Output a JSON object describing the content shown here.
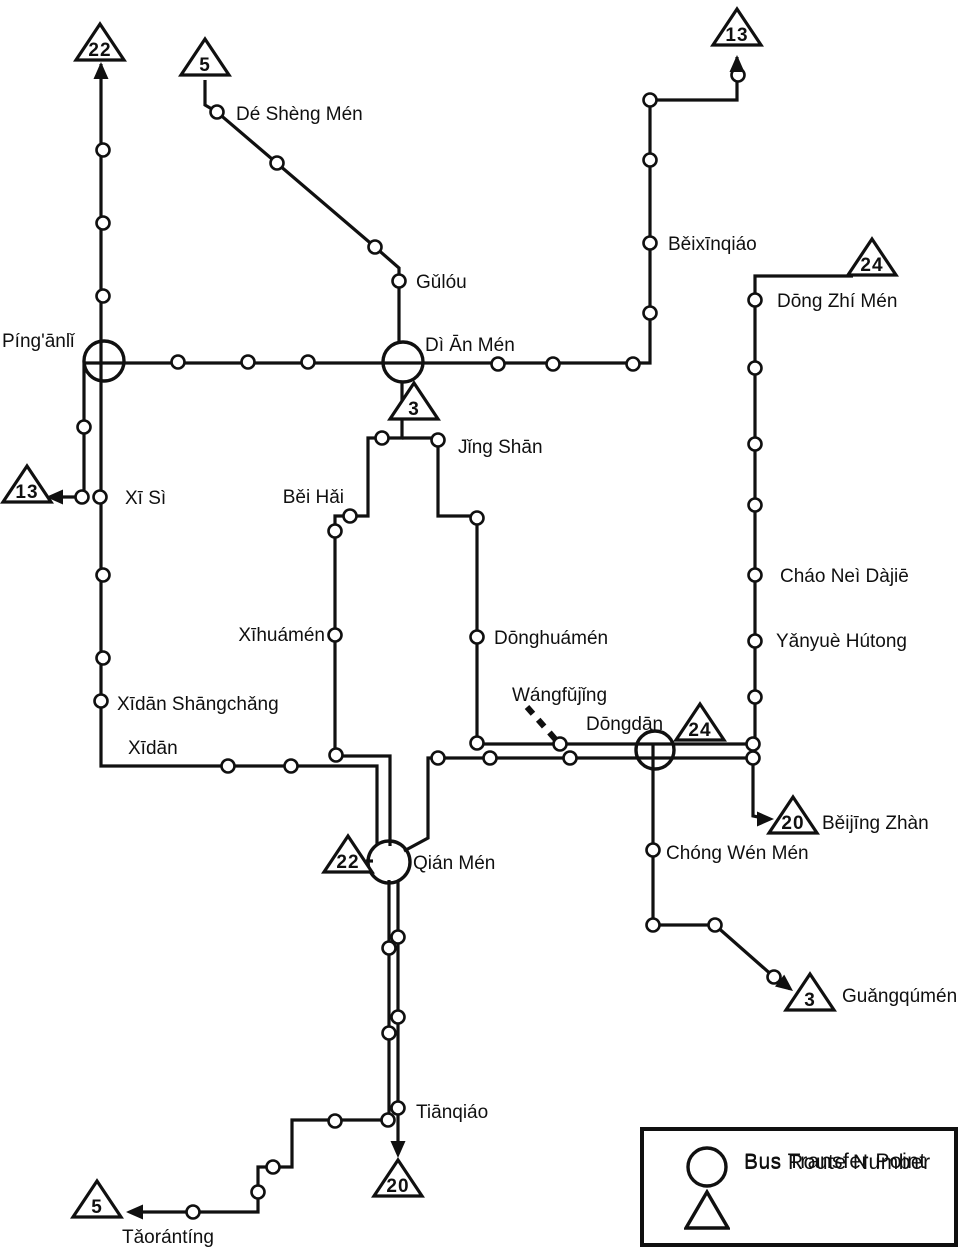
{
  "colors": {
    "ink": "#101010",
    "bg": "#ffffff"
  },
  "legend": {
    "transfer_label": "Bus Transfer Point",
    "route_label": "Bus Route Number"
  },
  "map": {
    "width": 971,
    "height": 1254,
    "lines": [
      {
        "name": "route-22-vertical-and-xidan-east",
        "points": [
          [
            101,
            64
          ],
          [
            101,
            766
          ],
          [
            377,
            766
          ],
          [
            377,
            845
          ]
        ]
      },
      {
        "name": "route-5-north-diagonal",
        "points": [
          [
            205,
            80
          ],
          [
            205,
            105
          ],
          [
            217,
            112
          ],
          [
            375,
            247
          ],
          [
            399,
            268
          ],
          [
            399,
            344
          ]
        ]
      },
      {
        "name": "route-5-west-palace-loop",
        "points": [
          [
            402,
            381
          ],
          [
            402,
            438
          ],
          [
            368,
            438
          ],
          [
            368,
            516
          ],
          [
            335,
            516
          ],
          [
            335,
            756
          ],
          [
            390,
            756
          ],
          [
            390,
            846
          ]
        ]
      },
      {
        "name": "route-3-east-palace-loop",
        "points": [
          [
            402,
            438
          ],
          [
            438,
            438
          ],
          [
            438,
            516
          ],
          [
            477,
            516
          ],
          [
            477,
            744
          ],
          [
            755,
            744
          ]
        ]
      },
      {
        "name": "route-3-south-branch",
        "points": [
          [
            653,
            744
          ],
          [
            653,
            925
          ],
          [
            715,
            925
          ],
          [
            774,
            977
          ],
          [
            790,
            989
          ]
        ]
      },
      {
        "name": "route-24-vertical",
        "points": [
          [
            853,
            276
          ],
          [
            755,
            276
          ],
          [
            755,
            744
          ]
        ]
      },
      {
        "name": "route-13-long-line",
        "points": [
          [
            737,
            57
          ],
          [
            737,
            100
          ],
          [
            650,
            100
          ],
          [
            650,
            363
          ],
          [
            84,
            363
          ],
          [
            84,
            497
          ],
          [
            52,
            497
          ]
        ]
      },
      {
        "name": "route-20-beijing-zhan-spur",
        "points": [
          [
            753,
            758
          ],
          [
            753,
            816
          ],
          [
            768,
            819
          ]
        ]
      },
      {
        "name": "route-20-main",
        "points": [
          [
            753,
            758
          ],
          [
            428,
            758
          ],
          [
            428,
            838
          ],
          [
            404,
            851
          ]
        ]
      },
      {
        "name": "route-20-south",
        "points": [
          [
            398,
            880
          ],
          [
            398,
            1150
          ]
        ]
      },
      {
        "name": "route-5-south-stairs",
        "points": [
          [
            389,
            880
          ],
          [
            389,
            1120
          ],
          [
            292,
            1120
          ],
          [
            292,
            1167
          ],
          [
            258,
            1167
          ],
          [
            258,
            1212
          ],
          [
            138,
            1212
          ]
        ]
      },
      {
        "name": "qianmen-badge-connector",
        "points": [
          [
            366,
            861
          ],
          [
            373,
            861
          ]
        ]
      }
    ],
    "dashed_lines": [
      {
        "name": "wangfujing-pointer",
        "points": [
          [
            527,
            707
          ],
          [
            556,
            740
          ]
        ]
      }
    ],
    "stops": [
      [
        103,
        150
      ],
      [
        103,
        223
      ],
      [
        103,
        296
      ],
      [
        178,
        362
      ],
      [
        248,
        362
      ],
      [
        308,
        362
      ],
      [
        498,
        364
      ],
      [
        553,
        364
      ],
      [
        633,
        364
      ],
      [
        84,
        427
      ],
      [
        82,
        497
      ],
      [
        100,
        497
      ],
      [
        103,
        575
      ],
      [
        103,
        658
      ],
      [
        101,
        701
      ],
      [
        228,
        766
      ],
      [
        291,
        766
      ],
      [
        217,
        112
      ],
      [
        277,
        163
      ],
      [
        375,
        247
      ],
      [
        399,
        281
      ],
      [
        738,
        75
      ],
      [
        650,
        100
      ],
      [
        650,
        160
      ],
      [
        650,
        243
      ],
      [
        650,
        313
      ],
      [
        755,
        300
      ],
      [
        755,
        368
      ],
      [
        755,
        444
      ],
      [
        755,
        505
      ],
      [
        755,
        575
      ],
      [
        755,
        641
      ],
      [
        755,
        697
      ],
      [
        382,
        438
      ],
      [
        350,
        516
      ],
      [
        335,
        531
      ],
      [
        335,
        635
      ],
      [
        336,
        755
      ],
      [
        438,
        440
      ],
      [
        477,
        518
      ],
      [
        477,
        637
      ],
      [
        477,
        743
      ],
      [
        560,
        744
      ],
      [
        438,
        758
      ],
      [
        490,
        758
      ],
      [
        570,
        758
      ],
      [
        753,
        744
      ],
      [
        753,
        758
      ],
      [
        389,
        948
      ],
      [
        398,
        937
      ],
      [
        389,
        1033
      ],
      [
        398,
        1017
      ],
      [
        398,
        1108
      ],
      [
        388,
        1120
      ],
      [
        335,
        1121
      ],
      [
        273,
        1167
      ],
      [
        258,
        1192
      ],
      [
        193,
        1212
      ],
      [
        653,
        850
      ],
      [
        653,
        925
      ],
      [
        715,
        925
      ],
      [
        774,
        977
      ]
    ],
    "transfer_points": [
      {
        "name": "Píng'ānlǐ",
        "x": 104,
        "y": 361,
        "r": 20
      },
      {
        "name": "Dì Ān Mén",
        "x": 403,
        "y": 362,
        "r": 20
      },
      {
        "name": "Dōngdān",
        "x": 655,
        "y": 750,
        "r": 19
      },
      {
        "name": "Qián Mén",
        "x": 389,
        "y": 862,
        "r": 21
      }
    ],
    "route_badges": [
      {
        "number": "22",
        "x": 100,
        "y": 45
      },
      {
        "number": "5",
        "x": 205,
        "y": 60
      },
      {
        "number": "13",
        "x": 737,
        "y": 30
      },
      {
        "number": "24",
        "x": 872,
        "y": 260
      },
      {
        "number": "13",
        "x": 27,
        "y": 487
      },
      {
        "number": "3",
        "x": 414,
        "y": 404
      },
      {
        "number": "24",
        "x": 700,
        "y": 725
      },
      {
        "number": "20",
        "x": 793,
        "y": 818
      },
      {
        "number": "22",
        "x": 348,
        "y": 857
      },
      {
        "number": "3",
        "x": 810,
        "y": 995
      },
      {
        "number": "20",
        "x": 398,
        "y": 1181
      },
      {
        "number": "5",
        "x": 97,
        "y": 1202
      }
    ],
    "arrows": [
      {
        "x": 101,
        "y": 62,
        "angle": -90
      },
      {
        "x": 737,
        "y": 55,
        "angle": -90
      },
      {
        "x": 46,
        "y": 497,
        "angle": 180
      },
      {
        "x": 774,
        "y": 819,
        "angle": 0
      },
      {
        "x": 793,
        "y": 991,
        "angle": 38
      },
      {
        "x": 398,
        "y": 1158,
        "angle": 90
      },
      {
        "x": 126,
        "y": 1212,
        "angle": 180
      }
    ],
    "labels": [
      {
        "text": "Dé Shèng Mén",
        "x": 236,
        "y": 120,
        "anchor": "start"
      },
      {
        "text": "Gǔlóu",
        "x": 416,
        "y": 288,
        "anchor": "start"
      },
      {
        "text": "Běixīnqiáo",
        "x": 668,
        "y": 250,
        "anchor": "start"
      },
      {
        "text": "Dōng Zhí Mén",
        "x": 777,
        "y": 307,
        "anchor": "start"
      },
      {
        "text": "Píng'ānlǐ",
        "x": 2,
        "y": 347,
        "anchor": "start"
      },
      {
        "text": "Dì Ān Mén",
        "x": 425,
        "y": 351,
        "anchor": "start"
      },
      {
        "text": "Jǐng Shān",
        "x": 458,
        "y": 453,
        "anchor": "start"
      },
      {
        "text": "Xī Sì",
        "x": 125,
        "y": 504,
        "anchor": "start"
      },
      {
        "text": "Běi Hǎi",
        "x": 344,
        "y": 503,
        "anchor": "end"
      },
      {
        "text": "Cháo Neì Dàjiē",
        "x": 780,
        "y": 582,
        "anchor": "start"
      },
      {
        "text": "Yǎnyuè Hútong",
        "x": 776,
        "y": 647,
        "anchor": "start"
      },
      {
        "text": "Xīhuámén",
        "x": 325,
        "y": 641,
        "anchor": "end"
      },
      {
        "text": "Dōnghuámén",
        "x": 494,
        "y": 644,
        "anchor": "start"
      },
      {
        "text": "Xīdān Shāngchǎng",
        "x": 117,
        "y": 710,
        "anchor": "start"
      },
      {
        "text": "Xīdān",
        "x": 128,
        "y": 754,
        "anchor": "start"
      },
      {
        "text": "Wángfǔjǐng",
        "x": 512,
        "y": 701,
        "anchor": "start"
      },
      {
        "text": "Dōngdān",
        "x": 586,
        "y": 730,
        "anchor": "start"
      },
      {
        "text": "Qián Mén",
        "x": 413,
        "y": 869,
        "anchor": "start"
      },
      {
        "text": "Chóng Wén Mén",
        "x": 666,
        "y": 859,
        "anchor": "start"
      },
      {
        "text": "Běijīng Zhàn",
        "x": 822,
        "y": 829,
        "anchor": "start"
      },
      {
        "text": "Guǎngqúmén",
        "x": 842,
        "y": 1002,
        "anchor": "start"
      },
      {
        "text": "Tiānqiáo",
        "x": 416,
        "y": 1118,
        "anchor": "start"
      },
      {
        "text": "Tǎorántíng",
        "x": 122,
        "y": 1243,
        "anchor": "start"
      }
    ]
  }
}
